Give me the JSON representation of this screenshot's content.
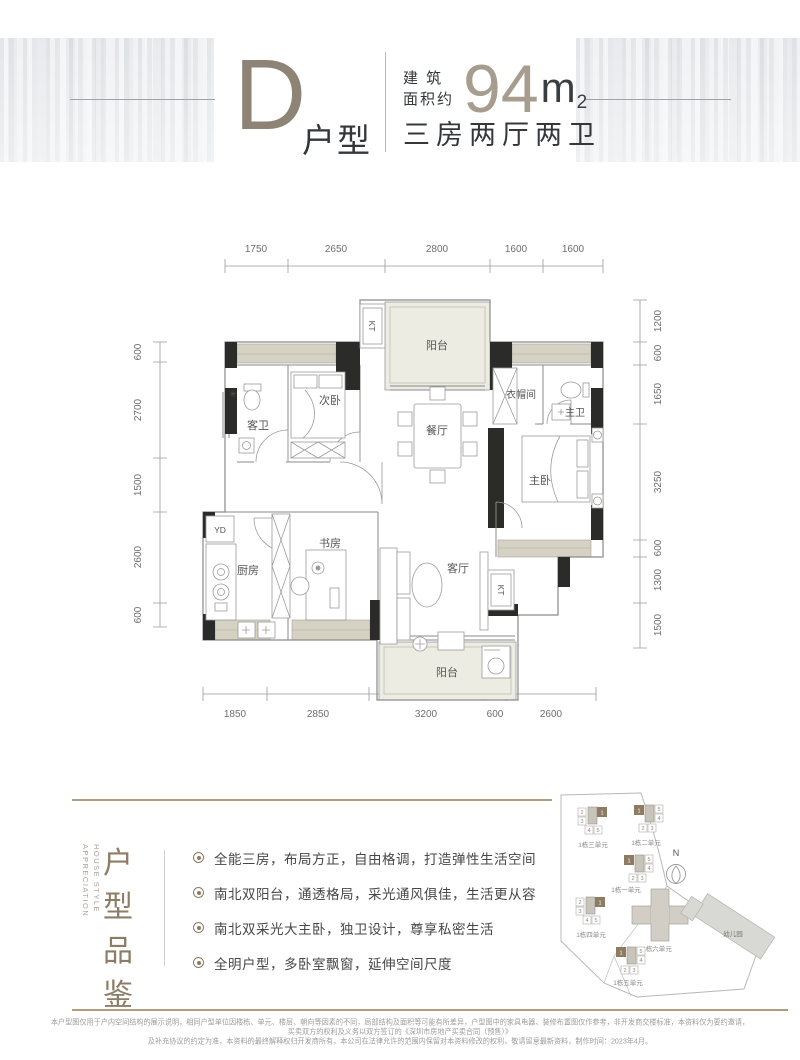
{
  "header": {
    "title_letter": "D",
    "title_suffix": "户型",
    "area_label_line1": "建 筑",
    "area_label_line2": "面积约",
    "area_value": "94",
    "area_unit": "m",
    "area_exponent": "2",
    "layout_text": "三房两厅两卫"
  },
  "floorplan": {
    "dims_top": [
      "1750",
      "2650",
      "2800",
      "1600",
      "1600"
    ],
    "dims_bottom": [
      "1850",
      "2850",
      "3200",
      "600",
      "2600"
    ],
    "dims_left": [
      "600",
      "2700",
      "1500",
      "2600",
      "600"
    ],
    "dims_right": [
      "1200",
      "600",
      "1650",
      "3250",
      "600",
      "1300",
      "1500"
    ],
    "rooms": {
      "balcony_top": "阳台",
      "guest_bath": "客卫",
      "bedroom2": "次卧",
      "dining": "餐厅",
      "cloakroom": "衣帽间",
      "master_bath": "主卫",
      "master_bedroom": "主卧",
      "kitchen": "厨房",
      "study": "书房",
      "living": "客厅",
      "balcony_bottom": "阳台"
    },
    "marks": {
      "kt_top": "KT",
      "kt_right": "KT",
      "yd": "YD"
    }
  },
  "appreciation": {
    "en_line1": "HOUSE STYLE",
    "en_line2": "APPRECIATION",
    "title_chars": [
      "户",
      "型",
      "品",
      "鉴"
    ],
    "bullets": [
      "全能三房，布局方正，自由格调，打造弹性生活空间",
      "南北双阳台，通透格局，采光通风俱佳，生活更从容",
      "南北双采光大主卧，独卫设计，尊享私密生活",
      "全明户型，多卧室飘窗，延伸空间尺度"
    ]
  },
  "sitemap": {
    "compass_label": "N",
    "kindergarten_label": "幼儿园",
    "buildings": [
      {
        "name": "1栋三单元",
        "units": [
          "2",
          "3",
          "1",
          "4",
          "5"
        ]
      },
      {
        "name": "1栋二单元",
        "units": [
          "1",
          "5",
          "4",
          "2",
          "3"
        ]
      },
      {
        "name": "1栋一单元",
        "units": [
          "1",
          "5",
          "4",
          "2",
          "3"
        ]
      },
      {
        "name": "1栋四单元",
        "units": [
          "2",
          "3",
          "1",
          "4",
          "5"
        ]
      },
      {
        "name": "1栋六单元",
        "units": []
      },
      {
        "name": "1栋五单元",
        "units": [
          "1",
          "5",
          "4",
          "2",
          "3"
        ]
      }
    ]
  },
  "footer": {
    "line1": "本户型图仅用于户内空间结构的展示说明，相同户型单位因楼栋、单元、楼层、朝向等因素的不同，局部结构及面积等可能有所差异，户型图中的家具电器、装修布置图仅作参考，非开发商交楼标准，本资料仅为要约邀请，买卖双方的权利及义务以双方签订的《深圳市房地产买卖合同（预售）》",
    "line2": "及补充协议的约定为准，本资料的最终解释权归开发商所有，本公司在法律允许的范围内保留对本资料修改的权利，敬请留意最新资料，制作时间：2023年4月。"
  },
  "colors": {
    "accent_brown": "#8d7b62",
    "title_taupe": "#8d8476",
    "area_value_taupe": "#a69d8e",
    "wall_black": "#2b2b29",
    "sill_beige": "#d6d2c3",
    "balcony_fill": "#ecece3"
  }
}
